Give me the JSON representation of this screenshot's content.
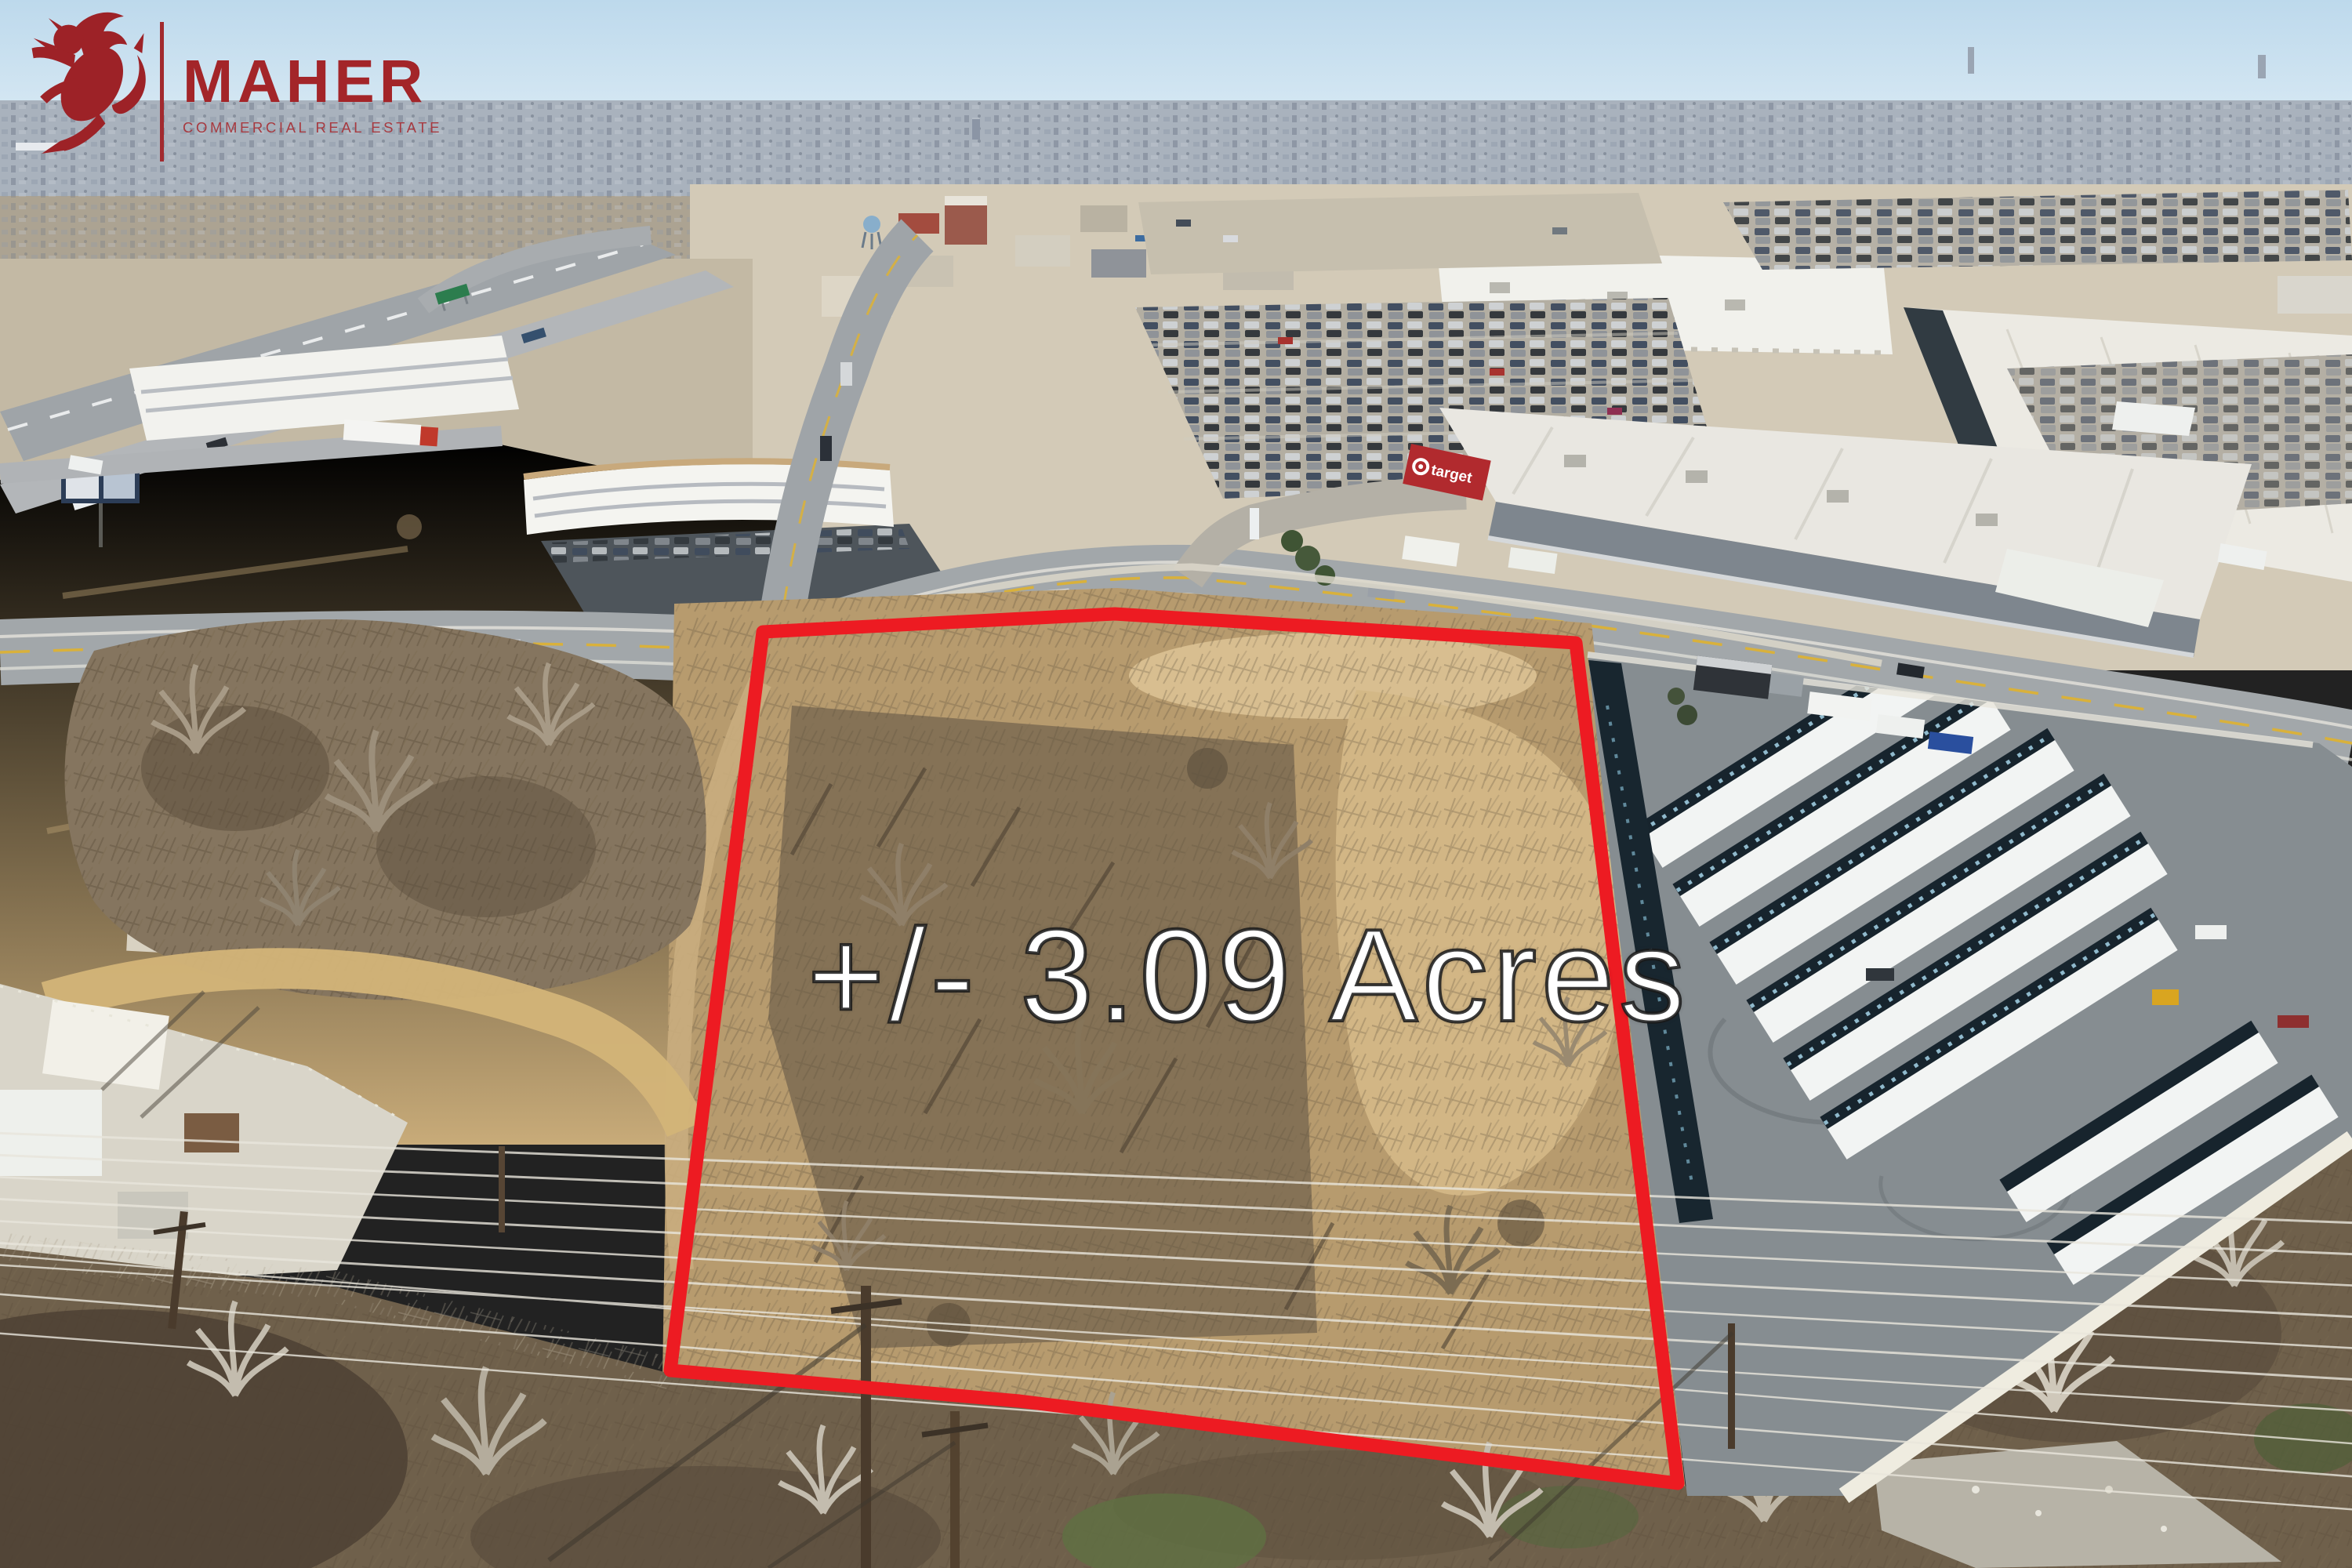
{
  "branding": {
    "company": "MAHER",
    "tagline": "COMMERCIAL REAL ESTATE",
    "brand_color": "#a32529"
  },
  "overlay": {
    "acreage_label": "+/- 3.09 Acres",
    "outline_color": "#ed1b22",
    "label_color": "#ffffff"
  },
  "landmarks": {
    "target_store": {
      "label": "target",
      "sign_color": "#b12a2e"
    }
  },
  "scene": {
    "setting": "aerial photo of vacant treed parcel outlined in red beside retail corridor, highway, hotels, Target store, mall and self-storage facility"
  }
}
